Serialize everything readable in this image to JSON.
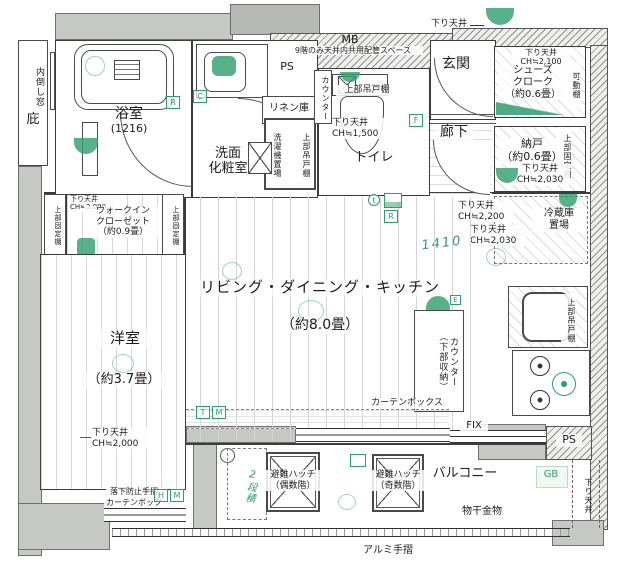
{
  "colors": {
    "accent_green": "#2f9e6e",
    "wall_gray": "#c6c8c6"
  },
  "exterior": {
    "eaves": "庇",
    "inward_window": "内倒し窓",
    "down_ceiling_top": "下り天井"
  },
  "shaft": {
    "mb": "MB",
    "mb_note": "9階のみ天井内共用配管スペース",
    "ps_top": "PS",
    "ps_bottom": "PS",
    "gb": "GB"
  },
  "bathroom": {
    "name": "浴室",
    "size": "(1216)"
  },
  "washroom": {
    "name": "洗面\n化粧室",
    "linen": "リネン庫",
    "washer": "洗濯機置場",
    "upper_cabinet": "上部吊戸棚"
  },
  "toilet": {
    "name": "トイレ",
    "counter": "カウンター",
    "upper_cabinet": "上部吊戸棚",
    "down_ceiling": "下り天井\nCH≒1,500"
  },
  "entrance": {
    "name": "玄関",
    "hallway": "廊下"
  },
  "shoes_closet": {
    "name": "シューズ\nクローク\n（約0.6畳）",
    "down_ceiling": "下り天井\nCH≒2,100",
    "movable_shelf": "可動棚"
  },
  "storage_room": {
    "name": "納戸\n（約0.6畳）",
    "fixed_shelf": "上部固定棚",
    "down_ceiling": "下り天井\nCH≒2,030"
  },
  "kitchen": {
    "down_ceiling_a": "下り天井\nCH≒2,200",
    "down_ceiling_b": "下り天井\nCH≒2,030",
    "fridge_space": "冷蔵庫\n置場",
    "upper_cabinet": "上部吊戸棚",
    "counter": "カウンター\n（下部収納）",
    "handwritten_width": "1410"
  },
  "living": {
    "name": "リビング・ダイニング・キッチン",
    "size": "（約8.0畳）",
    "curtain_box": "カーテンボックス",
    "fix_window": "FIX"
  },
  "wic": {
    "name": "ウォークイン\nクローゼット\n（約0.9畳）",
    "fixed_shelf_left": "上部固定棚",
    "fixed_shelf_right": "上部固定棚",
    "down_ceiling_a": "下り天井\nCH≒2,000",
    "down_ceiling_b": "下り天井\nCH≒1,970"
  },
  "bedroom": {
    "name": "洋室",
    "size": "（約3.7畳）",
    "down_ceiling": "下り天井\nCH≒2,000",
    "fall_rail": "落下防止手摺",
    "curtain_box": "カーテンボックス"
  },
  "balcony": {
    "name": "バルコニー",
    "hatch_even": "避難ハッチ\n（偶数階）",
    "hatch_odd": "避難ハッチ\n（奇数階）",
    "laundry_fitting": "物干金物",
    "rail": "アルミ手摺",
    "handwritten_note": "2段積",
    "down_ceiling": "下り天井"
  },
  "markers": {
    "r1": "R",
    "c1": "C",
    "t_small": "t",
    "r2": "R",
    "f1": "F",
    "t1": "T",
    "m1": "M",
    "h1": "H",
    "m2": "M",
    "e1": "E"
  }
}
